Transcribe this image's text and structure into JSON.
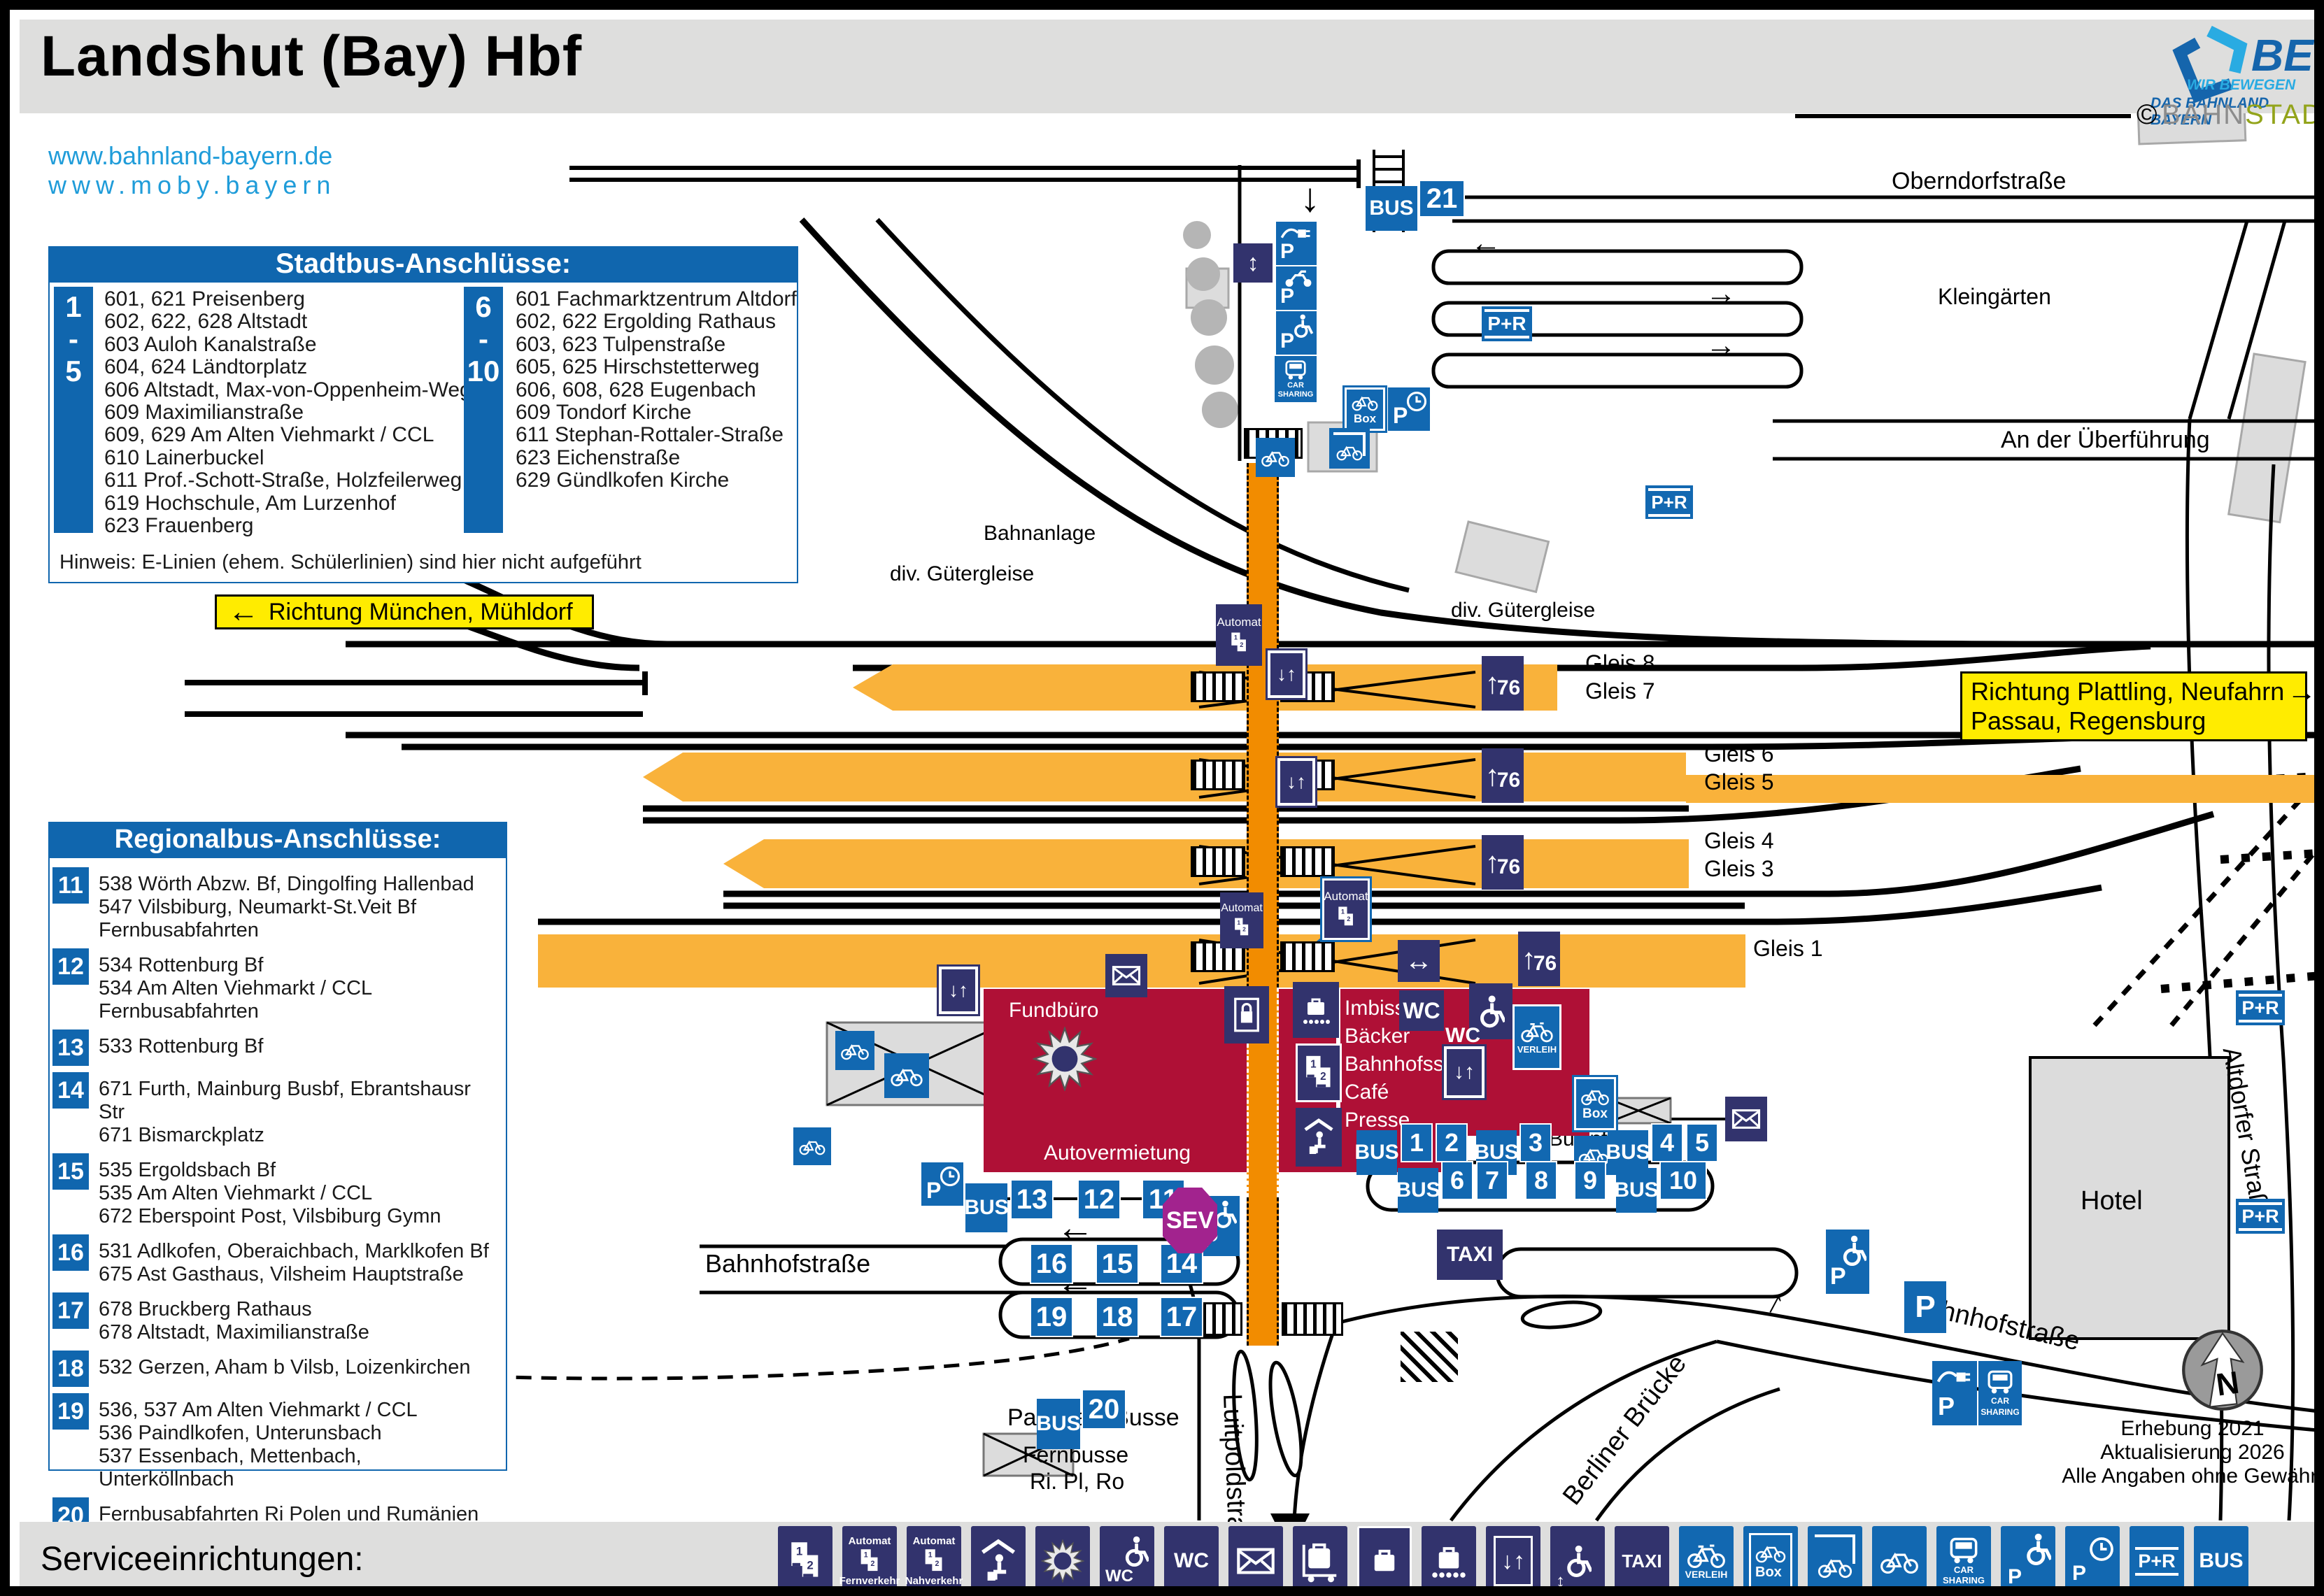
{
  "title": "Landshut (Bay) Hbf",
  "links": {
    "l1": "www.bahnland-bayern.de",
    "l2": "www.moby.bayern"
  },
  "beg": {
    "name": "BEG",
    "t1": "WIR BEWEGEN",
    "t2": "DAS BAHNLAND BAYERN"
  },
  "bahnstadt": {
    "c": "©",
    "p1": "BAHN",
    "p2": "STADT"
  },
  "stadtbus": {
    "title": "Stadtbus-Anschlüsse:",
    "g1": {
      "n1": "1",
      "dash": "-",
      "n2": "5",
      "lines": [
        "601, 621 Preisenberg",
        "602, 622, 628 Altstadt",
        "603 Auloh Kanalstraße",
        "604, 624 Ländtorplatz",
        "606 Altstadt, Max-von-Oppenheim-Weg",
        "609 Maximilianstraße",
        "609, 629 Am Alten Viehmarkt / CCL",
        "610 Lainerbuckel",
        "611 Prof.-Schott-Straße, Holzfeilerweg",
        "619 Hochschule, Am Lurzenhof",
        "623 Frauenberg"
      ]
    },
    "g2": {
      "n1": "6",
      "dash": "-",
      "n2": "10",
      "lines": [
        "601 Fachmarktzentrum Altdorf",
        "602, 622 Ergolding Rathaus",
        "603, 623 Tulpenstraße",
        "605, 625 Hirschstetterweg",
        "606, 608, 628 Eugenbach",
        "609 Tondorf Kirche",
        "611 Stephan-Rottaler-Straße",
        "623 Eichenstraße",
        "629 Gündlkofen Kirche"
      ]
    },
    "note": "Hinweis: E-Linien (ehem. Schülerlinien) sind hier nicht aufgeführt"
  },
  "regionalbus": {
    "title": "Regionalbus-Anschlüsse:",
    "items": [
      {
        "nr": "11",
        "lines": [
          "538 Wörth Abzw. Bf, Dingolfing Hallenbad",
          "547 Vilsbiburg, Neumarkt-St.Veit Bf",
          "Fernbusabfahrten"
        ]
      },
      {
        "nr": "12",
        "lines": [
          "534 Rottenburg Bf",
          "534 Am Alten Viehmarkt / CCL",
          "Fernbusabfahrten"
        ]
      },
      {
        "nr": "13",
        "lines": [
          "533 Rottenburg Bf"
        ]
      },
      {
        "nr": "14",
        "lines": [
          "671 Furth, Mainburg Busbf, Ebrantshausr Str",
          "671 Bismarckplatz"
        ]
      },
      {
        "nr": "15",
        "lines": [
          "535 Ergoldsbach Bf",
          "535 Am Alten Viehmarkt / CCL",
          "672 Eberspoint Post, Vilsbiburg Gymn"
        ]
      },
      {
        "nr": "16",
        "lines": [
          "531 Adlkofen, Oberaichbach, Marklkofen Bf",
          "675 Ast Gasthaus, Vilsheim Hauptstraße"
        ]
      },
      {
        "nr": "17",
        "lines": [
          "678 Bruckberg Rathaus",
          "678 Altstadt, Maximilianstraße"
        ]
      },
      {
        "nr": "18",
        "lines": [
          "532 Gerzen, Aham b Vilsb, Loizenkirchen"
        ]
      },
      {
        "nr": "19",
        "lines": [
          "536, 537 Am Alten Viehmarkt / CCL",
          "536 Paindlkofen, Unterunsbach",
          "537 Essenbach, Mettenbach, Unterköllnbach"
        ]
      },
      {
        "nr": "20",
        "lines": [
          "Fernbusabfahrten Ri Polen und Rumänien"
        ]
      },
      {
        "nr": "21",
        "lines": [
          "617 Hauptbahnhof"
        ]
      }
    ]
  },
  "signs": {
    "west": "Richtung München, Mühldorf",
    "east1": "Richtung Plattling, Neufahrn",
    "east2": "Passau, Regensburg"
  },
  "map": {
    "labels": {
      "oberndorf": "Oberndorfstraße",
      "kleingaerten": "Kleingärten",
      "ueberfuehrung": "An der Überführung",
      "bahnanlage": "Bahnanlage",
      "gueter1": "div. Gütergleise",
      "gueter2": "div. Gütergleise",
      "gleis8": "Gleis 8",
      "gleis7": "Gleis 7",
      "gleis6": "Gleis 6",
      "gleis5": "Gleis 5",
      "gleis4": "Gleis 4",
      "gleis3": "Gleis 3",
      "gleis1": "Gleis 1",
      "bahnhofstr_w": "Bahnhofstraße",
      "bahnhofstr_e": "Bahnhofstraße",
      "luitpold": "Luitpoldstraße",
      "berliner": "Berliner Brücke",
      "stadtmitte": "Stadtmitte",
      "altdorfer": "Altdorfer Straße",
      "parkplatz": "Parkplatz Busse",
      "fernbusse1": "Fernbusse",
      "fernbusse2": "Ri. Pl, Ro",
      "hotel": "Hotel",
      "businfo": "Businfo"
    }
  },
  "building": {
    "fundbuero": "Fundbüro",
    "autovermietung": "Autovermietung",
    "shops": [
      "Imbiss",
      "Bäcker",
      "Bahnhofsshop",
      "Café",
      "Presse"
    ]
  },
  "stops": {
    "bus": "BUS",
    "sev": "SEV",
    "taxi": "TAXI",
    "n21": "21",
    "n20": "20",
    "row1": [
      "13",
      "12",
      "11"
    ],
    "row2": [
      "16",
      "15",
      "14"
    ],
    "row3": [
      "19",
      "18",
      "17"
    ],
    "r1a": [
      "1",
      "2"
    ],
    "r1b": "3",
    "r1c": [
      "4",
      "5"
    ],
    "r2a": [
      "6",
      "7"
    ],
    "r2b": "8",
    "r2c": "9",
    "r2d": "10"
  },
  "badges": {
    "p": "P",
    "pr": "P+R",
    "box": "Box",
    "verleih": "VERLEIH",
    "car1": "CAR",
    "car2": "SHARING",
    "automat": "Automat",
    "wc": "WC",
    "u76": "76",
    "one": "1",
    "two": "2"
  },
  "icons": {
    "left": "←",
    "right": "→",
    "up": "↑",
    "down": "↓",
    "downup": "↓↑",
    "lr": "↔",
    "ud": "↕"
  },
  "compass": {
    "n": "N",
    "l1": "Erhebung 2021",
    "l2": "Aktualisierung 2026",
    "l3": "Alle Angaben ohne Gewähr!"
  },
  "footer": {
    "title": "Serviceeinrichtungen:",
    "automat": "Automat",
    "fern": "Fernverkehr",
    "nah": "Nahverkehr",
    "wc": "WC",
    "taxi": "TAXI",
    "verleih": "VERLEIH",
    "box": "Box",
    "car1": "CAR",
    "car2": "SHARING",
    "p": "P",
    "pr": "P+R",
    "bus": "BUS",
    "one": "1",
    "two": "2"
  }
}
